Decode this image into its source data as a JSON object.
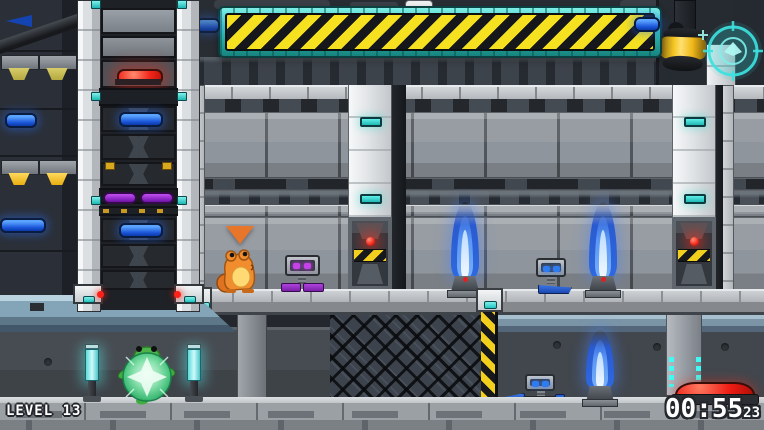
{
  "hud": {
    "level_label": "LEVEL 13",
    "timer": {
      "minutes_seconds": "00:55",
      "centiseconds": "23"
    },
    "reticle_icon": "targeting-reticle"
  },
  "colors": {
    "accent_cyan": "#3ee0dc",
    "hazard_yellow": "#f2d81e",
    "hazard_black": "#17181b",
    "alarm_red": "#ee1f1a",
    "glow_blue": "#2f7bf0",
    "jet_blue": "#3b82f2",
    "bubble_green": "#57d98f",
    "purple_accent": "#a238d8",
    "steel_light": "#c6cacd",
    "steel_mid": "#8f959c",
    "steel_dark": "#2a2e33",
    "navy_wall": "#252a31"
  },
  "entities": {
    "player": "orange-frog",
    "companion": "green-frog-in-bubble",
    "marker": "pointer-triangle",
    "robots": [
      "purple-mini-robot",
      "blue-mini-robot",
      "blue-mini-robot-floor"
    ],
    "hazards": [
      "flame-jet-platform-left",
      "flame-jet-platform-right",
      "flame-jet-floor"
    ],
    "buttons": [
      "red-button-ladder",
      "red-button-floor"
    ],
    "lamps": [
      "red-lamp-left-door",
      "red-lamp-right-door",
      "cyan-light-post-left",
      "cyan-light-post-right",
      "yellow-cylinder-lamp",
      "green-wall-lamp"
    ]
  }
}
